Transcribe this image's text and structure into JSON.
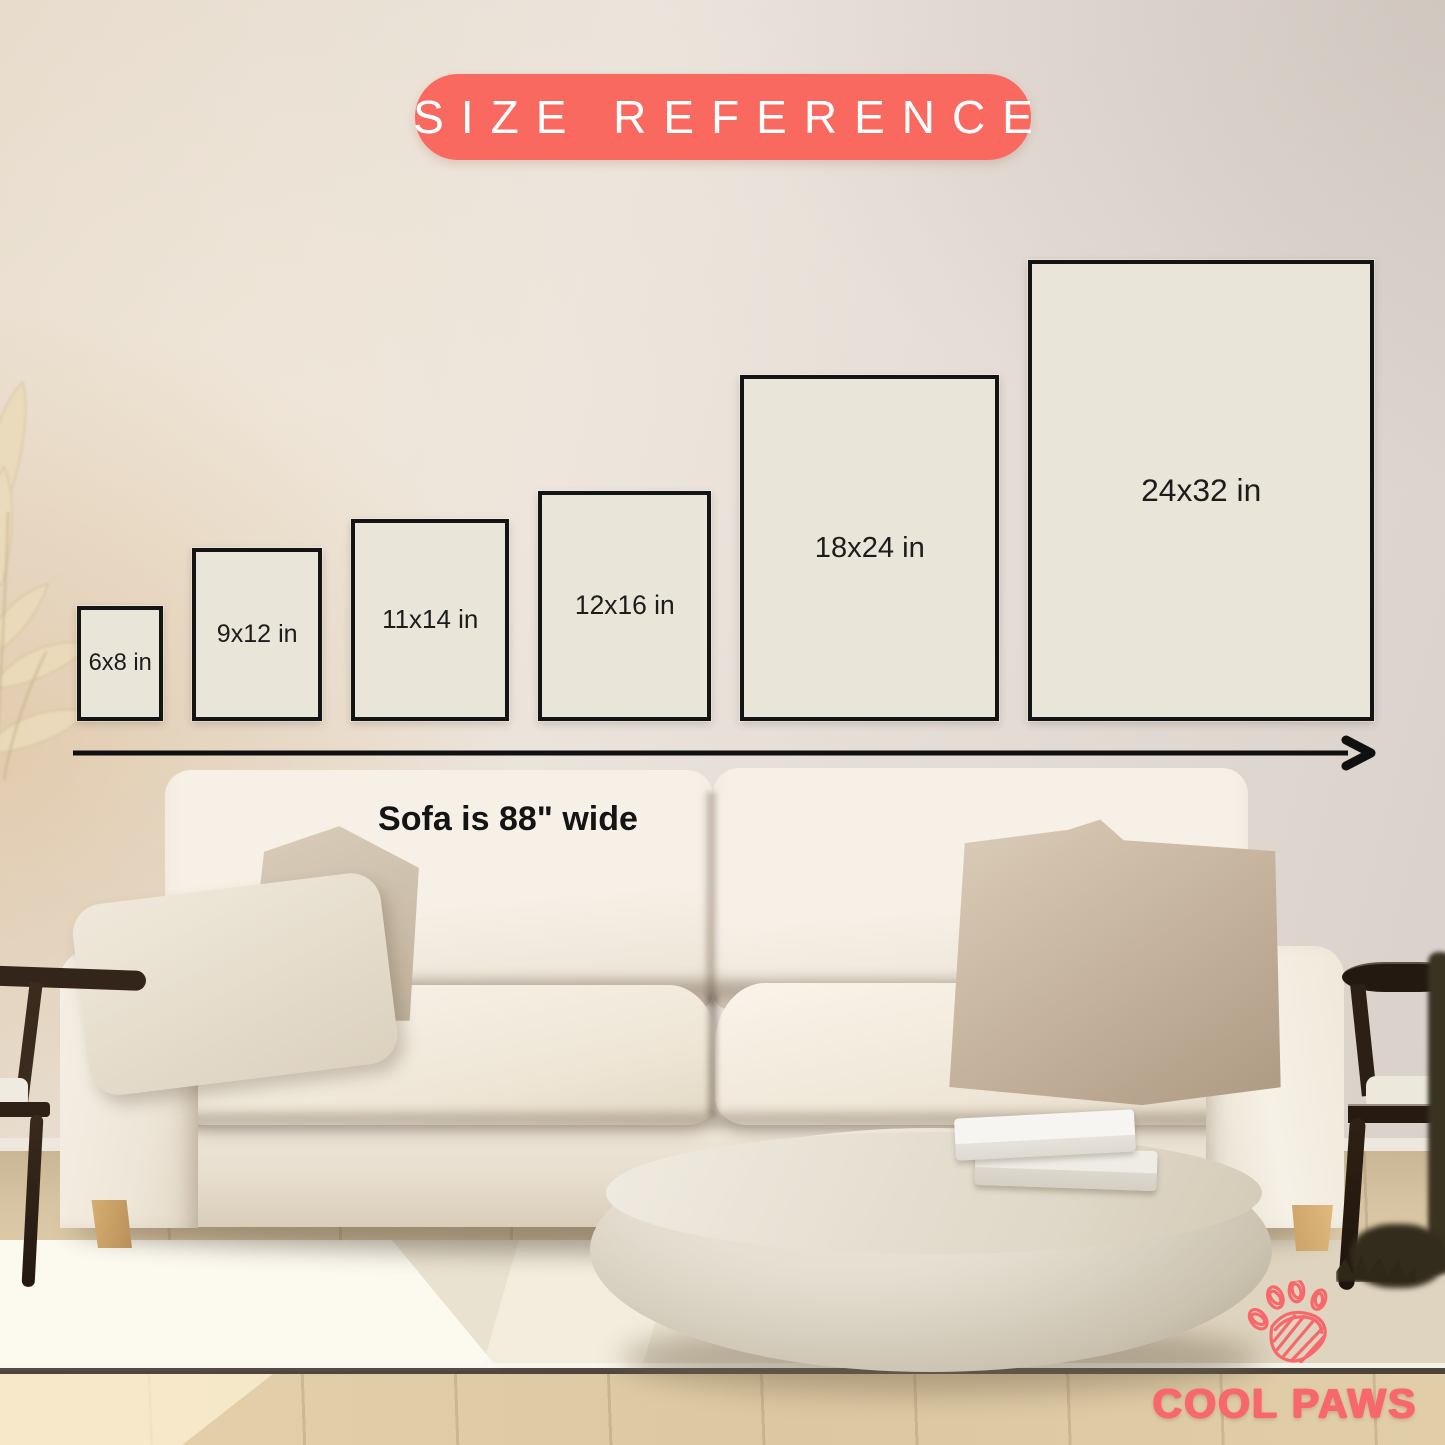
{
  "badge": {
    "label": "SIZE REFERENCE",
    "bg_color": "#F9695F",
    "text_color": "#FFFFFF"
  },
  "size_chart": {
    "unit": "in",
    "sizes": [
      {
        "label": "6x8 in",
        "w": 6,
        "h": 8
      },
      {
        "label": "9x12 in",
        "w": 9,
        "h": 12
      },
      {
        "label": "11x14 in",
        "w": 11,
        "h": 14
      },
      {
        "label": "12x16 in",
        "w": 12,
        "h": 16
      },
      {
        "label": "18x24 in",
        "w": 18,
        "h": 24
      },
      {
        "label": "24x32 in",
        "w": 24,
        "h": 32
      }
    ],
    "frame_fill": "#EAE5D9",
    "frame_border": "#141414",
    "sofa_note": "Sofa is 88\" wide"
  },
  "brand": {
    "name": "COOL PAWS",
    "color": "#F8686B",
    "icon": "paw-icon"
  }
}
